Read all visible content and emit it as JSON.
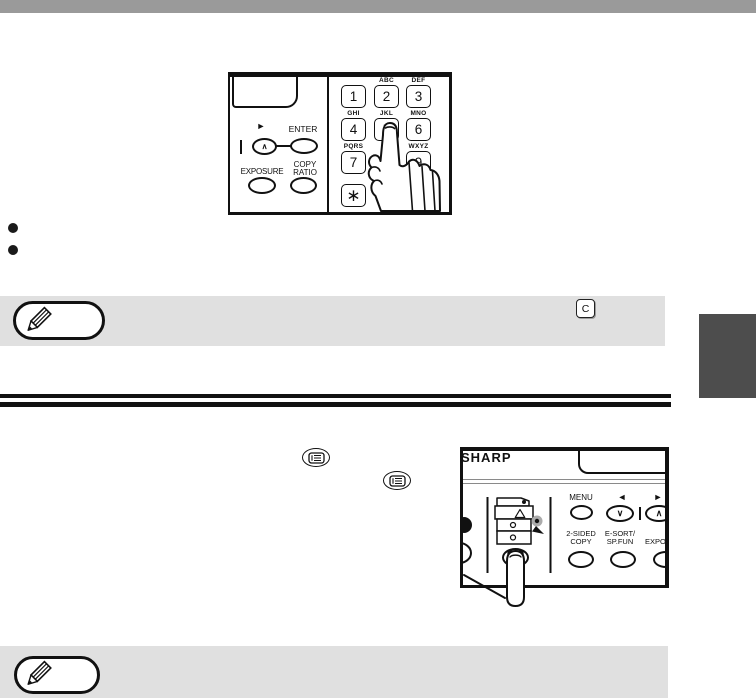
{
  "page": {
    "width": 756,
    "height": 698
  },
  "colors": {
    "header_bar": "#9a9a9a",
    "note_background": "#e0e0e0",
    "section_tab": "#4d4d4d",
    "ink": "#111111"
  },
  "figure_keypad": {
    "enter_label": "ENTER",
    "exposure_label": "EXPOSURE",
    "copy_ratio_line1": "COPY",
    "copy_ratio_line2": "RATIO",
    "arrow_right_glyph": "►",
    "chevron_up_glyph": "∧",
    "cut_label_fragment": "/",
    "star_key_glyph": "∗",
    "at_key_label": "@.-_",
    "keys": [
      {
        "digit": "1",
        "letters": ""
      },
      {
        "digit": "2",
        "letters": "ABC"
      },
      {
        "digit": "3",
        "letters": "DEF"
      },
      {
        "digit": "4",
        "letters": "GHI"
      },
      {
        "digit": "5",
        "letters": "JKL"
      },
      {
        "digit": "6",
        "letters": "MNO"
      },
      {
        "digit": "7",
        "letters": "PQRS"
      },
      {
        "digit": "9",
        "letters": "WXYZ"
      }
    ]
  },
  "bullet_list": {
    "marker": "●"
  },
  "note_top": {
    "clear_key_label": "C"
  },
  "figure_panel": {
    "brand": "SHARP",
    "menu_label": "MENU",
    "arrow_left_glyph": "◄",
    "arrow_right_glyph": "►",
    "chevron_down_glyph": "∨",
    "chevron_up_glyph": "∧",
    "two_sided_line1": "2-SIDED",
    "two_sided_line2": "COPY",
    "esort_line1": "E-SORT/",
    "esort_line2": "SP.FUN",
    "exposure_partial_label": "EXPOS"
  }
}
